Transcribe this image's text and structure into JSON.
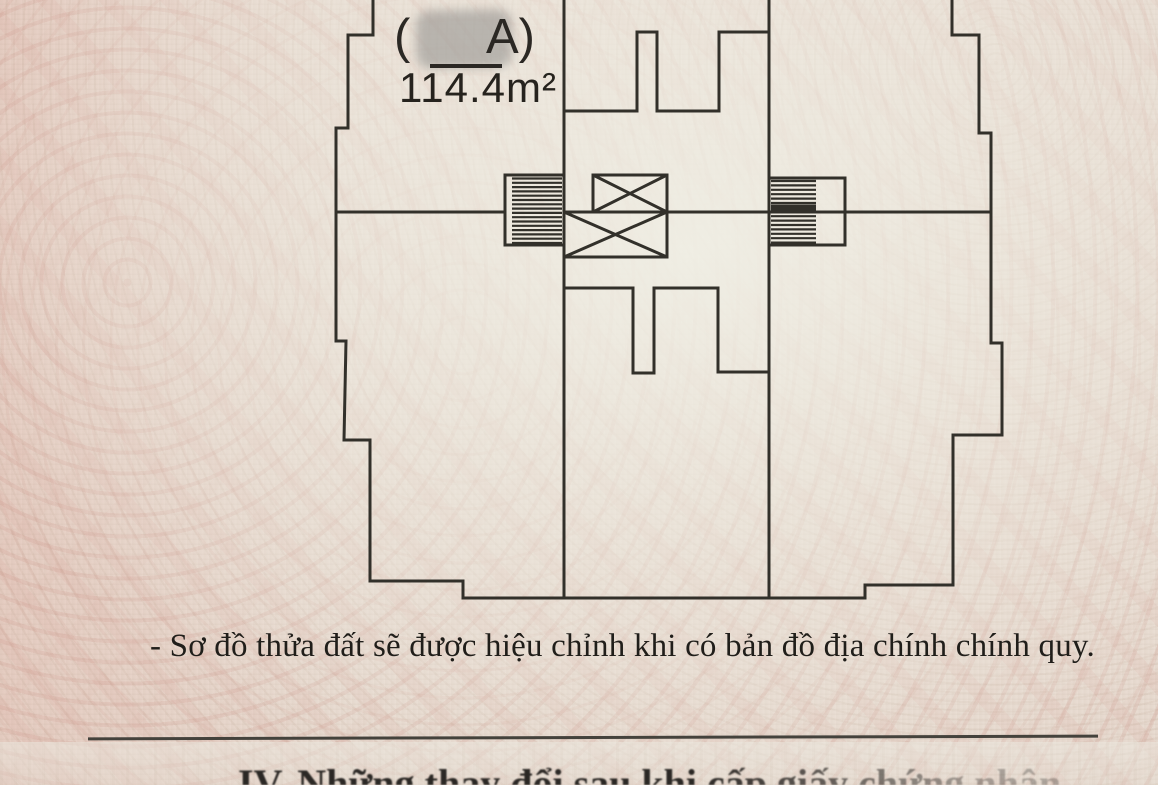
{
  "parcel_label": {
    "prefix": "(",
    "suffix": "A)"
  },
  "area": {
    "value": "114.4m²"
  },
  "caption": {
    "text": "- Sơ đồ thửa đất sẽ được hiệu chỉnh khi có bản đồ địa chính chính quy."
  },
  "next_section": {
    "heading": "IV. Những thay đổi sau khi cấp giấy chứng nhận"
  },
  "colors": {
    "paper": "#e9dcd2",
    "paper_light": "#eae7dc",
    "pink_pattern": "#d9a99c",
    "line_ink": "#32302a",
    "text_ink": "#26231e",
    "rule": "#44423c",
    "redaction_grey": "#94928f"
  }
}
